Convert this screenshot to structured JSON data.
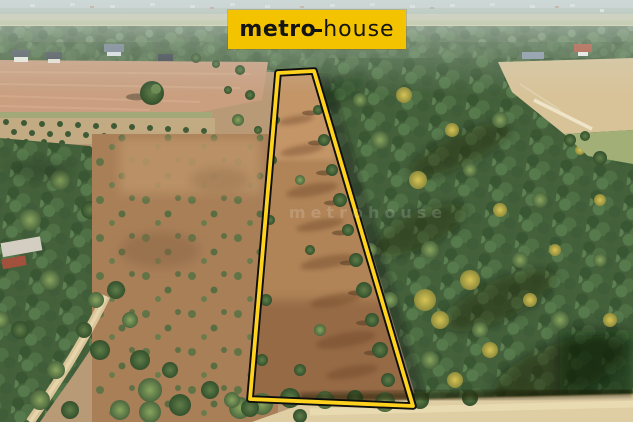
{
  "logo": {
    "bold_text": "metro",
    "light_text": "house",
    "background_color": "#F3C300",
    "text_color": "#141414"
  },
  "watermark": {
    "text": "metrohouse"
  },
  "overlay": {
    "plot_polygon_points": "278,73 314,71 413,406 250,399",
    "outline_yellow_color": "#FFD21E",
    "outline_black_color": "#0E0E0E"
  }
}
